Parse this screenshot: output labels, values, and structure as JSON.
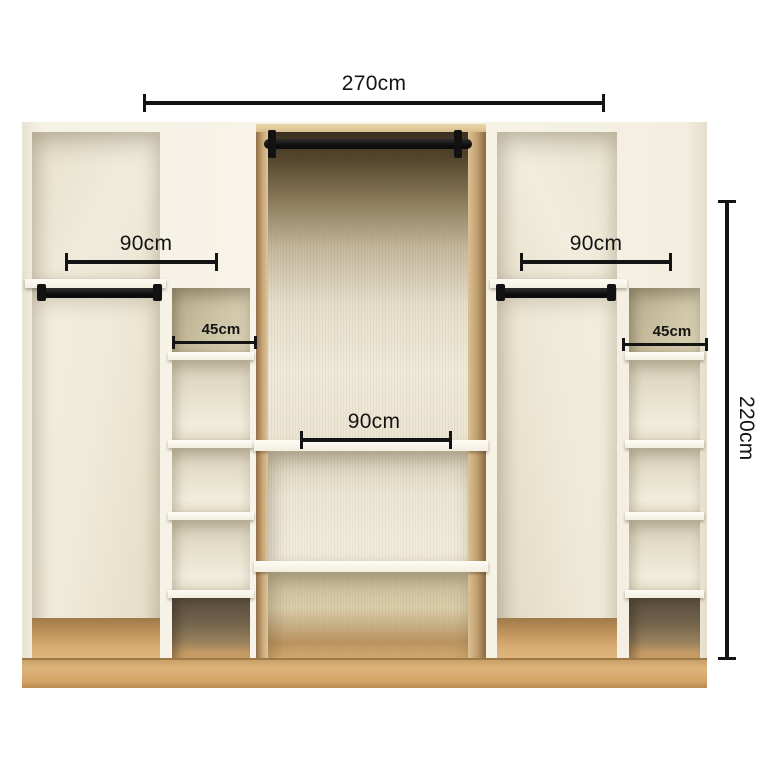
{
  "annotations": {
    "overall_width": "270cm",
    "overall_height": "220cm",
    "left_hanging_width": "90cm",
    "right_hanging_width": "90cm",
    "center_shelf_width": "90cm",
    "left_column_width": "45cm",
    "right_column_width": "45cm"
  },
  "colors": {
    "background": "#ffffff",
    "dimension_lines": "#141414",
    "cabinet_cream": "#f4f0e4",
    "interior_beige": "#e9e3d1",
    "olive_back_panel": "#cdc4a5",
    "wood_oak_base": "#d3a96e",
    "wood_edge": "#dcc094",
    "hanging_rod": "#121212"
  }
}
